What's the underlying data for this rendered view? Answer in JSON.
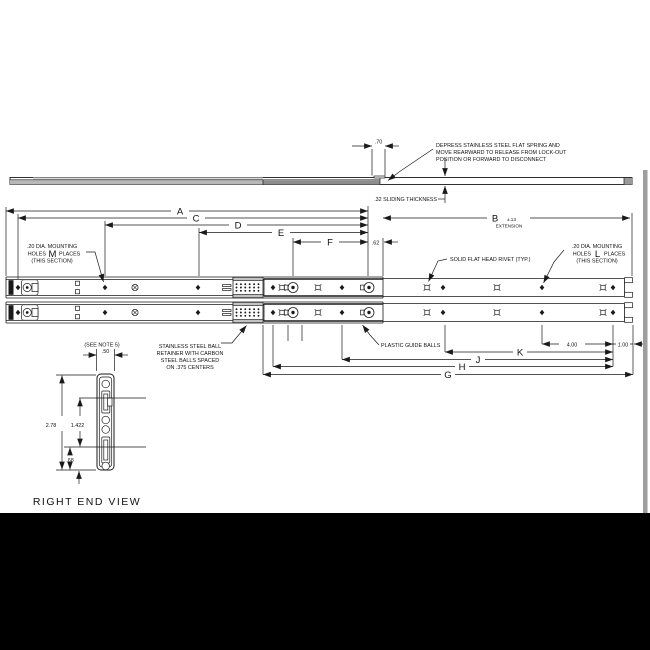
{
  "drawing": {
    "top_view": {
      "spring_note": [
        "DEPRESS STAINLESS STEEL FLAT SPRING AND",
        "MOVE REARWARD TO RELEASE FROM LOCK-OUT",
        "POSITION OR FORWARD TO DISCONNECT"
      ],
      "spring_offset": ".70",
      "sliding_thickness": ".32 SLIDING THICKNESS"
    },
    "dims": {
      "A": "A",
      "B": "B",
      "B_tol": "±.13",
      "B_sub": "EXTENSION",
      "C": "C",
      "D": "D",
      "E": "E",
      "F": "F",
      "G": "G",
      "H": "H",
      "J": "J",
      "K": "K",
      "d62": ".62",
      "d400": "4.00",
      "d100": "1.00"
    },
    "notes": {
      "left_holes": {
        "line1": ".20 DIA. MOUNTING",
        "holes": "HOLES",
        "count": "M",
        "places": "PLACES",
        "line3": "(THIS SECTION)"
      },
      "right_holes": {
        "line1": ".20 DIA. MOUNTING",
        "holes": "HOLES",
        "count": "L",
        "places": "PLACES",
        "line3": "(THIS SECTION)"
      },
      "rivet": "SOLID FLAT HEAD RIVET (TYP.)",
      "retainer": [
        "STAINLESS STEEL BALL",
        "RETAINER WITH CARBON",
        "STEEL BALLS SPACED",
        "ON .375 CENTERS"
      ],
      "guide_balls": "PLASTIC GUIDE BALLS"
    },
    "end_view": {
      "see_note": "(SEE NOTE 5)",
      "width": ".50",
      "height": "2.78",
      "inner": "1.422",
      "bottom": ".68",
      "caption": "RIGHT END VIEW"
    }
  },
  "colors": {
    "line": "#1a1a1a",
    "shade_light": "#c2c2c2",
    "shade_mid": "#8c8c8c",
    "frame": "#000000"
  }
}
